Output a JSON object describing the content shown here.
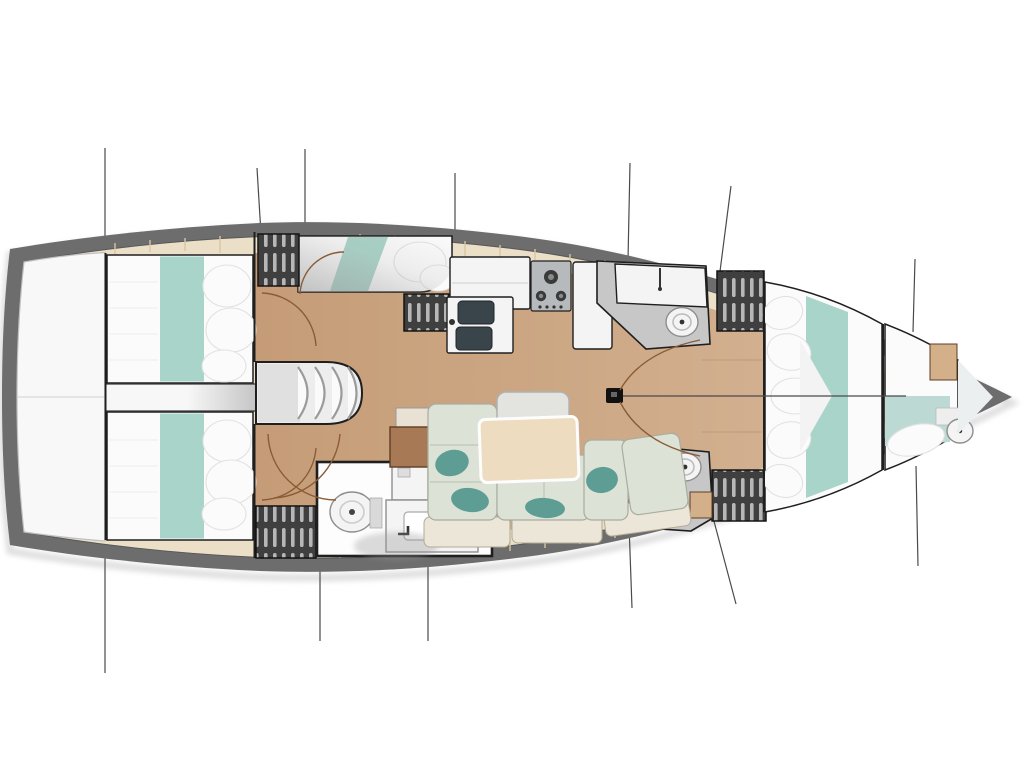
{
  "palette": {
    "page_bg": "#ffffff",
    "hull_band": "#6d6d6d",
    "hull_halo": "#dedede",
    "deck_cream": "#ebdfc8",
    "plank_seam": "#d8c5a2",
    "transom_white": "#f8f8f8",
    "transom_edge": "#c0c0c0",
    "floor_wood": "#c59c77",
    "floor_wood_light": "#d5b494",
    "bed_white": "#fbfbfb",
    "pillow_edge": "#e2e2e2",
    "fold_line": "#ededed",
    "teal_stripe": "#a9d4c9",
    "teal_stripe_light": "#bcd9d3",
    "teal_pillow": "#5e9d94",
    "wedge_light": "#f7f7f7",
    "wedge_dark": "#c6c6c6",
    "locker_dark": "#3f3f3f",
    "locker_slat": "#b7b7b7",
    "steps_fill": "#ededed",
    "steps_tread": "#fafafa",
    "steps_edge": "#9b9b9b",
    "counter_white": "#f4f4f4",
    "appliance_gray": "#b7babc",
    "burner_dark": "#3a3a3a",
    "sink_dark": "#39444b",
    "room_floor_gray": "#c7c7c7",
    "fixture_outline": "#8e8e8e",
    "settee": "#dde2d6",
    "settee_edge": "#a8ad9f",
    "backrest": "#ece6d8",
    "backrest_edge": "#b3ab96",
    "table_wood": "#eedcc0",
    "table_edge": "#fdfdfd",
    "nav_brown": "#a87955",
    "nav_edge": "#5f3d26",
    "tan_cabinet": "#d3b08a",
    "wall_dark": "#1f1f1f",
    "wall_mid": "#3a3a3a",
    "door_arc": "#8a5c36",
    "rig_line": "#4a4a4a",
    "mast_black": "#111111",
    "shadow_gray": "#9a9a9a"
  },
  "element_names": [
    "hull-outline",
    "swim-platform",
    "side-deck",
    "cabin-sole",
    "aft-cabin-port-bed",
    "aft-cabin-starboard-bed",
    "engine-space-wedge",
    "companionway-steps",
    "midship-berth",
    "hanging-locker",
    "galley-counter",
    "galley-stove",
    "galley-sink",
    "galley-cabinet",
    "forward-head",
    "aft-head-starboard",
    "day-head-shower",
    "salon-settee",
    "salon-table",
    "salon-bench",
    "nav-seat",
    "mast-post",
    "rigging-line",
    "door-swing-arc",
    "forward-cabin-berth",
    "bow-cabin-berth",
    "bow-head-toilet"
  ]
}
